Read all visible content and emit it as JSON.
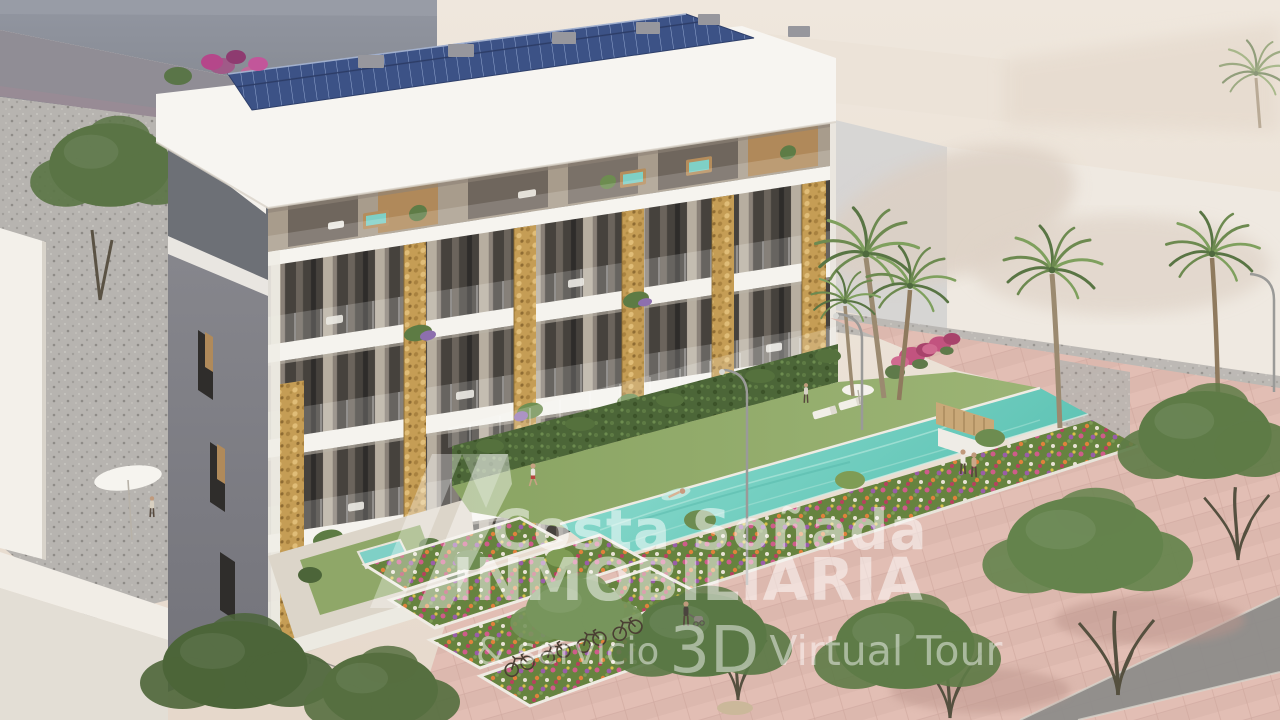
{
  "image": {
    "alt": "3D architectural rendering of a modern white apartment building with rooftop solar panels, golden stone pillars, planted balconies, a turquoise communal lap pool, lawns, flower beds, palm trees and a pink promenade",
    "width_px": 1280,
    "height_px": 720
  },
  "watermark": {
    "logo_icon": "costa-sonada-logo-mark",
    "brand_line1": "Costa Soñada",
    "brand_line2": "INMOBILIARIA",
    "tagline_prefix": "& servicio",
    "tagline_3d": "3D",
    "tagline_suffix": "Virtual Tour",
    "text_color": "#ffffff",
    "opacity": 0.5
  },
  "palette": {
    "background_beige": "#ece3d9",
    "background_gray_building": "#9195a0",
    "building_white": "#f5f3ee",
    "side_wall_gray": "#7e7e86",
    "stone_pillar_gold": "#c59d55",
    "solar_panel_blue": "#3c5286",
    "pool_teal": "#76d0c2",
    "lawn_green": "#93ac6b",
    "hedge_green": "#4c6638",
    "pavement_pink": "#dcb8ae",
    "tree_green": "#5f7c48",
    "bougainvillea_pink": "#c2537f",
    "flower_orange": "#e0813c"
  },
  "scene_elements": [
    "gray background building",
    "street with bougainvillea hedge",
    "green trees",
    "gravel yard",
    "white apartment building",
    "rooftop solar panels",
    "penthouse terraces with hot tubs",
    "golden stone pillars",
    "balconies with furniture and hanging plants",
    "garden hedge and glass pool fence",
    "lawn with sun loungers and parasol",
    "turquoise lap pool with swimmer",
    "terraced flower beds",
    "pink promenade",
    "palm trees",
    "curved street lamps",
    "parked bicycles",
    "pedestrians",
    "white foreground building"
  ]
}
